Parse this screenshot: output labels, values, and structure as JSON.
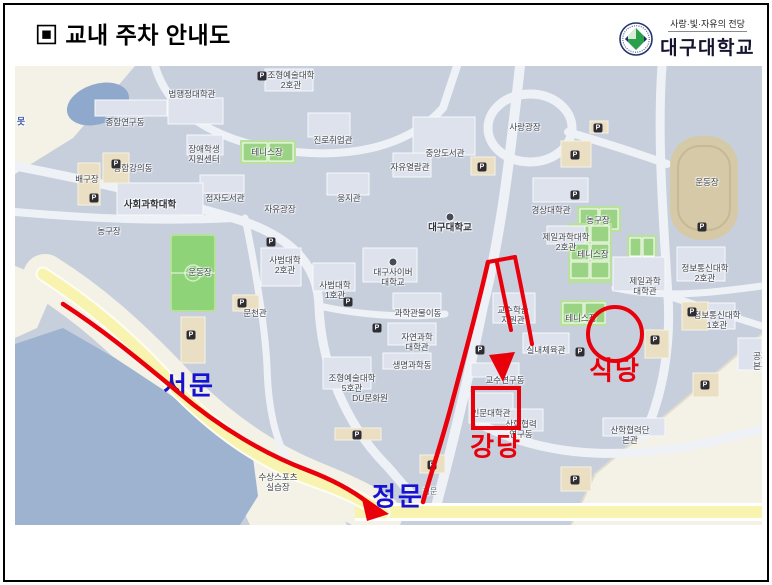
{
  "header": {
    "title": "▣ 교내 주차 안내도"
  },
  "logo": {
    "tagline": "사랑·빛·자유의 전당",
    "university": "대구대학교"
  },
  "colors": {
    "route_red": "#e8000b",
    "gate_blue": "#1712cf",
    "campus_base": "#c7cfdd",
    "road_yellow": "#f8f4b0",
    "field_green": "#8ed378",
    "water_blue": "#9db3d0"
  },
  "map": {
    "labels": [
      {
        "text": "종합연구동",
        "x": 110,
        "y": 56
      },
      {
        "text": "법행정대학관",
        "x": 177,
        "y": 28
      },
      {
        "text": "장애학생\n지원센터",
        "x": 189,
        "y": 88
      },
      {
        "text": "종합강의동",
        "x": 118,
        "y": 102
      },
      {
        "text": "배구장",
        "x": 72,
        "y": 113
      },
      {
        "text": "사회과학대학",
        "x": 135,
        "y": 139,
        "cls": "big"
      },
      {
        "text": "점자도서관",
        "x": 210,
        "y": 132
      },
      {
        "text": "농구장",
        "x": 94,
        "y": 165
      },
      {
        "text": "조형예술대학\n2호관",
        "x": 276,
        "y": 14
      },
      {
        "text": "진로취업관",
        "x": 318,
        "y": 74
      },
      {
        "text": "중앙도서관",
        "x": 430,
        "y": 87
      },
      {
        "text": "자유열람관",
        "x": 395,
        "y": 101
      },
      {
        "text": "웅지관",
        "x": 334,
        "y": 132
      },
      {
        "text": "자유광장",
        "x": 265,
        "y": 143
      },
      {
        "text": "대구대학교",
        "x": 435,
        "y": 162,
        "cls": "big"
      },
      {
        "text": "테니스장",
        "x": 252,
        "y": 86
      },
      {
        "text": "사랑광장",
        "x": 510,
        "y": 61
      },
      {
        "text": "운동장",
        "x": 692,
        "y": 116
      },
      {
        "text": "경상대학관",
        "x": 536,
        "y": 144
      },
      {
        "text": "농구장",
        "x": 583,
        "y": 154
      },
      {
        "text": "제일과학대학\n2호관",
        "x": 551,
        "y": 176
      },
      {
        "text": "테니스장",
        "x": 578,
        "y": 188
      },
      {
        "text": "제일과학\n대학관",
        "x": 630,
        "y": 220
      },
      {
        "text": "정보통신대학\n2호관",
        "x": 690,
        "y": 207
      },
      {
        "text": "테니스장",
        "x": 566,
        "y": 252
      },
      {
        "text": "정보통신대학\n1호관",
        "x": 702,
        "y": 254
      },
      {
        "text": "교수학습\n지원관",
        "x": 498,
        "y": 249
      },
      {
        "text": "실내체육관",
        "x": 531,
        "y": 284
      },
      {
        "text": "교수연구동",
        "x": 490,
        "y": 314
      },
      {
        "text": "인문대학관",
        "x": 476,
        "y": 347
      },
      {
        "text": "산학협력\n연구동",
        "x": 506,
        "y": 363
      },
      {
        "text": "산학협력단\n본관",
        "x": 615,
        "y": 369
      },
      {
        "text": "공과\n본관",
        "x": 746,
        "y": 295
      },
      {
        "text": "대구사이버\n대학교",
        "x": 378,
        "y": 211
      },
      {
        "text": "사범대학\n1호관",
        "x": 320,
        "y": 224
      },
      {
        "text": "과학관물이동",
        "x": 403,
        "y": 247
      },
      {
        "text": "자연과학\n대학관",
        "x": 402,
        "y": 276
      },
      {
        "text": "생명과학동",
        "x": 397,
        "y": 299
      },
      {
        "text": "조형예술대학\n5호관",
        "x": 337,
        "y": 317
      },
      {
        "text": "DU문화원",
        "x": 355,
        "y": 332
      },
      {
        "text": "사범대학\n2호관",
        "x": 270,
        "y": 199
      },
      {
        "text": "문천관",
        "x": 240,
        "y": 247
      },
      {
        "text": "운동장",
        "x": 185,
        "y": 206
      },
      {
        "text": "수상스포츠\n실습장",
        "x": 263,
        "y": 416
      },
      {
        "text": "정문",
        "x": 415,
        "y": 426,
        "cls": "tiny",
        "name": "main-gate-map-label"
      },
      {
        "text": "못",
        "x": 6,
        "y": 56,
        "cls": "pond",
        "name": "pond-label"
      },
      {
        "text": "서문",
        "x": 174,
        "y": 320,
        "cls": "gate",
        "name": "west-gate-label"
      },
      {
        "text": "정문",
        "x": 383,
        "y": 431,
        "cls": "gate",
        "name": "main-gate-label"
      },
      {
        "text": "강당",
        "x": 481,
        "y": 381,
        "cls": "spot",
        "name": "auditorium-label"
      },
      {
        "text": "식당",
        "x": 600,
        "y": 305,
        "cls": "spot",
        "name": "cafeteria-label"
      }
    ],
    "parking": {
      "glyph": "P",
      "positions": [
        [
          101,
          98
        ],
        [
          79,
          132
        ],
        [
          247,
          10
        ],
        [
          467,
          101
        ],
        [
          560,
          89
        ],
        [
          583,
          62
        ],
        [
          560,
          129
        ],
        [
          687,
          161
        ],
        [
          333,
          236
        ],
        [
          362,
          262
        ],
        [
          256,
          176
        ],
        [
          227,
          237
        ],
        [
          176,
          269
        ],
        [
          342,
          369
        ],
        [
          417,
          399
        ],
        [
          465,
          284
        ],
        [
          565,
          286
        ],
        [
          640,
          274
        ],
        [
          677,
          246
        ],
        [
          560,
          414
        ],
        [
          690,
          319
        ]
      ]
    }
  }
}
